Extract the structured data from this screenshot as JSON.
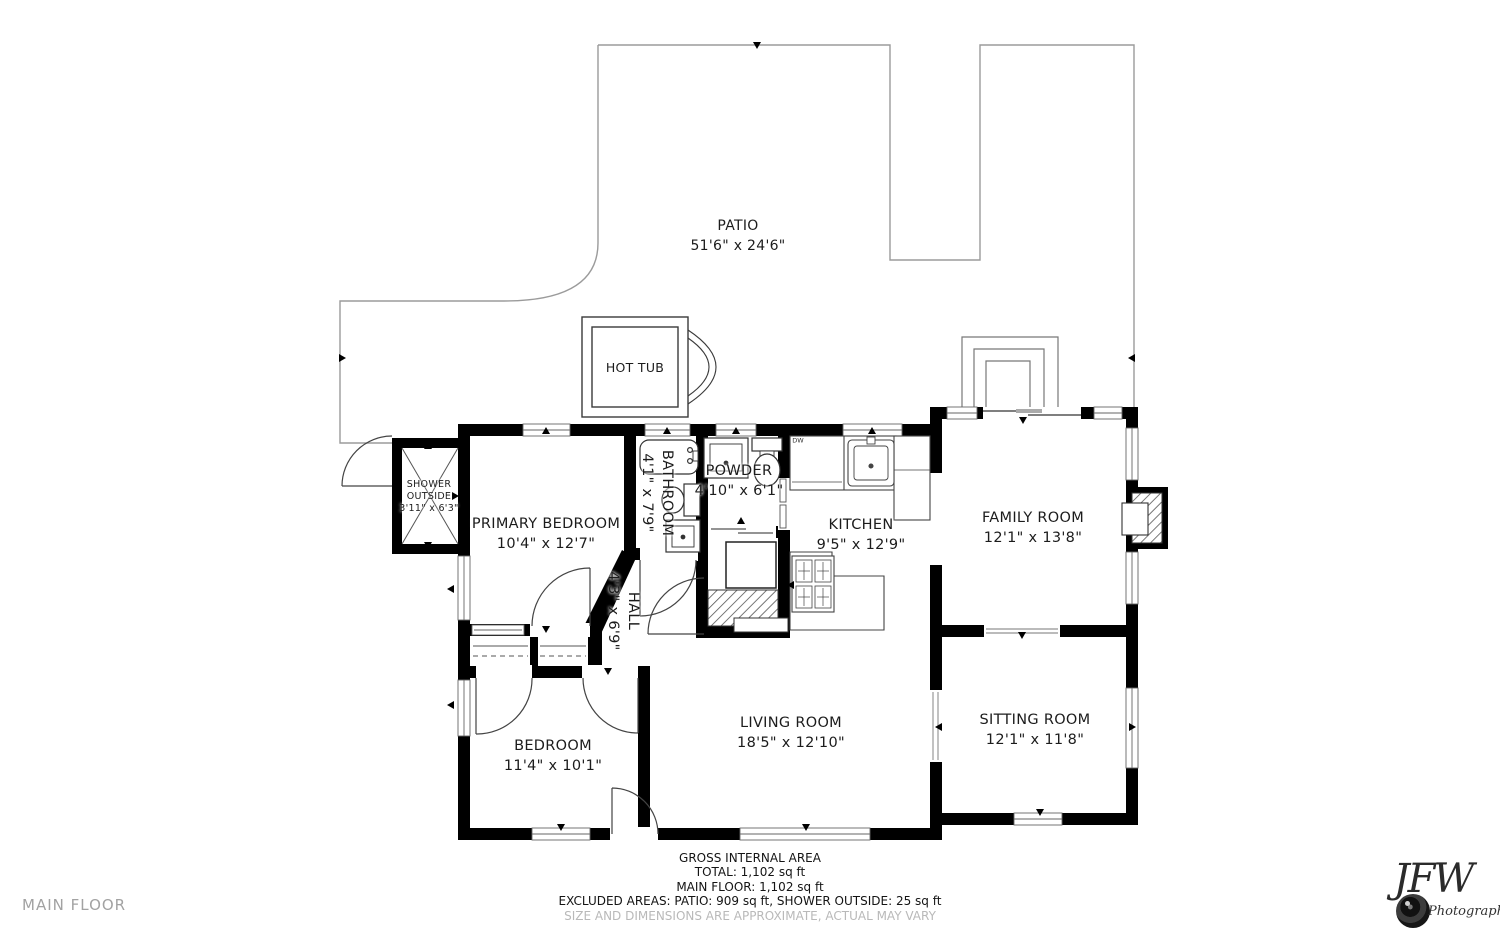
{
  "floor_label": "MAIN FLOOR",
  "patio": {
    "name": "PATIO",
    "dims": "51'6\" x 24'6\""
  },
  "hot_tub": {
    "name": "HOT TUB"
  },
  "shower_outside": {
    "name": "SHOWER OUTSIDE",
    "dims": "3'11\" x 6'3\""
  },
  "rooms": {
    "primary_bedroom": {
      "name": "PRIMARY BEDROOM",
      "dims": "10'4\" x 12'7\""
    },
    "bathroom": {
      "name": "BATHROOM",
      "dims": "4'1\" x 7'9\""
    },
    "powder": {
      "name": "POWDER",
      "dims": "4'10\" x 6'1\""
    },
    "kitchen": {
      "name": "KITCHEN",
      "dims": "9'5\" x 12'9\""
    },
    "family_room": {
      "name": "FAMILY ROOM",
      "dims": "12'1\" x 13'8\""
    },
    "hall": {
      "name": "HALL",
      "dims": "4'3\" x 6'9\""
    },
    "bedroom": {
      "name": "BEDROOM",
      "dims": "11'4\" x 10'1\""
    },
    "living_room": {
      "name": "LIVING ROOM",
      "dims": "18'5\" x 12'10\""
    },
    "sitting_room": {
      "name": "SITTING ROOM",
      "dims": "12'1\" x 11'8\""
    }
  },
  "labels": {
    "dishwasher": "DW"
  },
  "footer": {
    "line1": "GROSS INTERNAL AREA",
    "line2": "TOTAL: 1,102 sq ft",
    "line3": "MAIN FLOOR: 1,102 sq ft",
    "line4": "EXCLUDED AREAS: PATIO: 909 sq ft, SHOWER OUTSIDE: 25 sq ft",
    "line5": "SIZE AND DIMENSIONS ARE APPROXIMATE, ACTUAL MAY VARY"
  },
  "logo": {
    "initials": "JFW",
    "subtitle": "Photography"
  }
}
